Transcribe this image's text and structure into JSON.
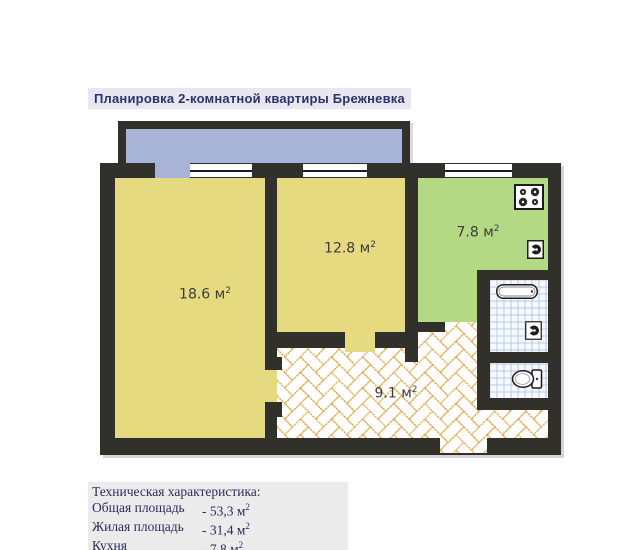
{
  "title": "Планировка 2-комнатной квартиры Брежневка",
  "areas": {
    "room1": {
      "value": "18.6 м",
      "sup": "2"
    },
    "room2": {
      "value": "12.8 м",
      "sup": "2"
    },
    "kitchen": {
      "value": "7.8 м",
      "sup": "2"
    },
    "hallway": {
      "value": "9.1 м",
      "sup": "2"
    }
  },
  "specs": {
    "heading": "Техническая характеристика:",
    "rows": [
      {
        "label": "Общая площадь",
        "value": "- 53,3 м",
        "sup": "2"
      },
      {
        "label": "Жилая площадь",
        "value": "- 31,4 м",
        "sup": "2"
      },
      {
        "label": "Кухня",
        "value": "- 7,8 м",
        "sup": "2"
      }
    ]
  },
  "colors": {
    "wall": "#32302a",
    "room_fill": "#e6da81",
    "kitchen_fill": "#b4d985",
    "balcony_fill": "#a8b4d7",
    "brick_line": "#d9a13e",
    "tile_line": "#b5cbe5",
    "title_text": "#2f3168"
  }
}
